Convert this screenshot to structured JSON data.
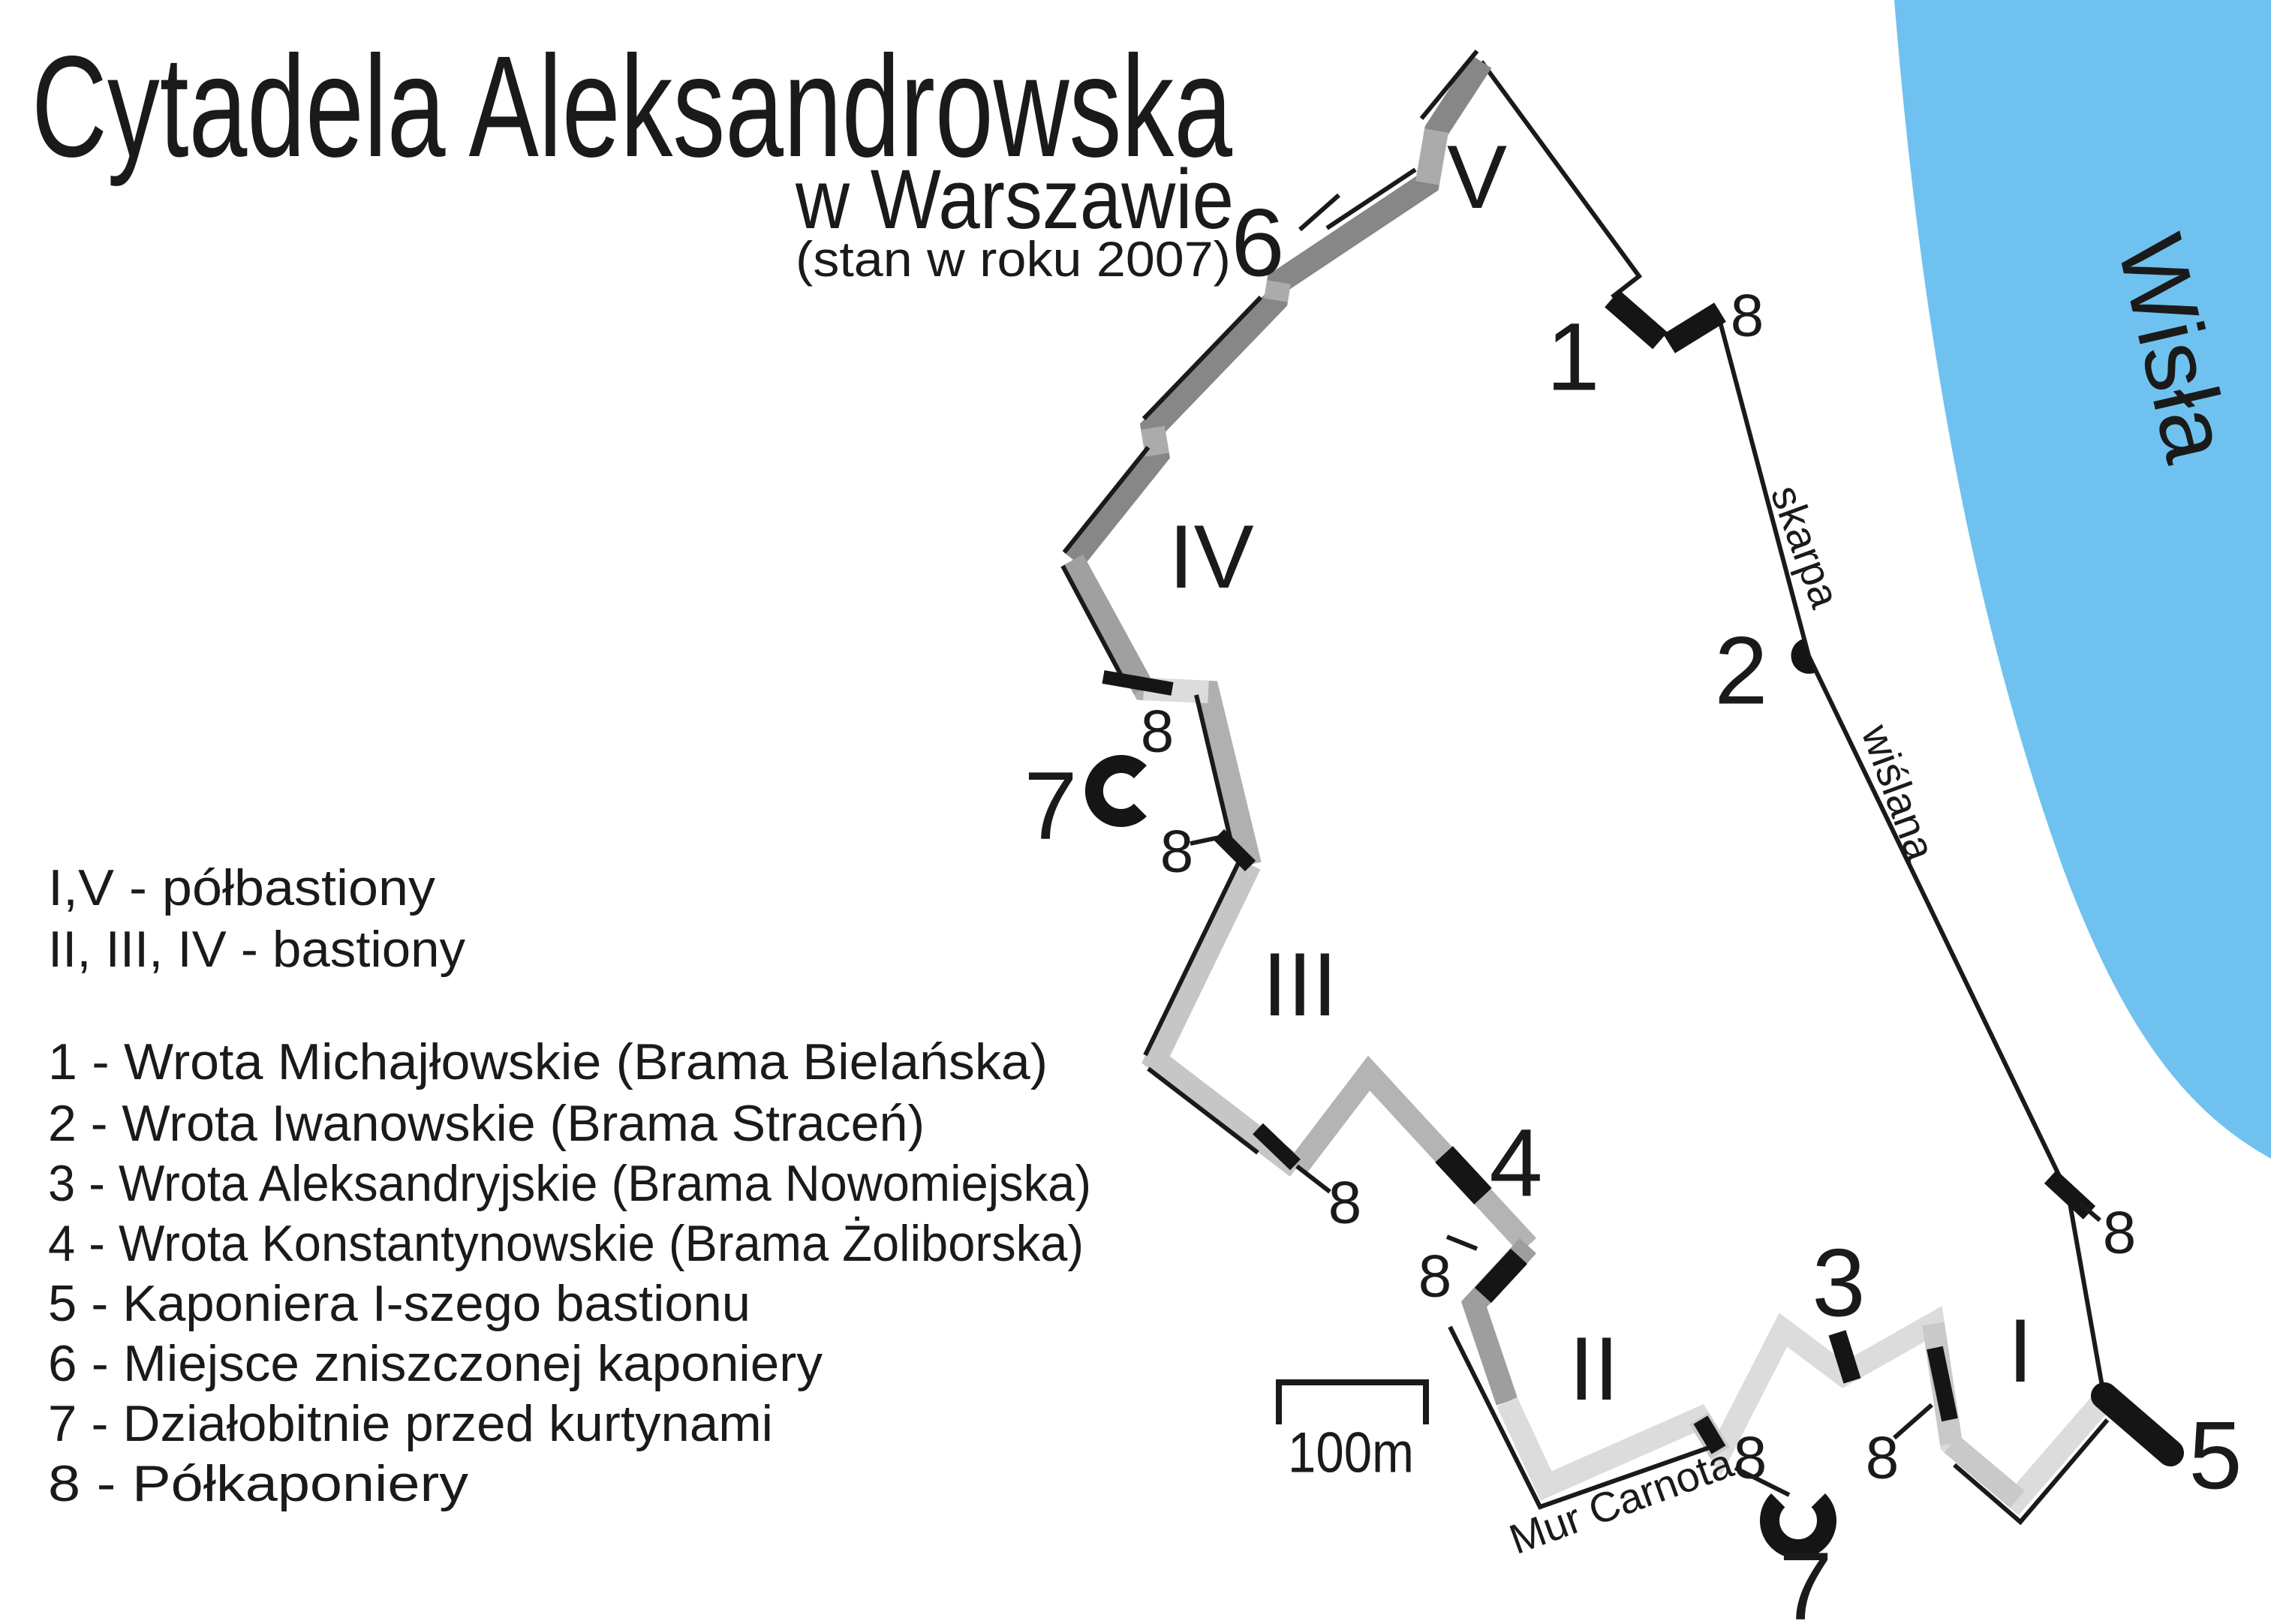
{
  "title": {
    "main": "Cytadela Aleksandrowska",
    "subtitle": "w Warszawie",
    "note": "(stan w roku 2007)"
  },
  "legend": {
    "classes": [
      "I,V - półbastiony",
      "II, III, IV - bastiony"
    ],
    "items": [
      "1 - Wrota Michajłowskie (Brama Bielańska)",
      "2 - Wrota Iwanowskie (Brama Straceń)",
      "3 - Wrota Aleksandryjskie (Brama Nowomiejska)",
      "4 - Wrota Konstantynowskie (Brama Żoliborska)",
      "5 - Kaponiera I-szego bastionu",
      "6 - Miejsce zniszczonej kaponiery",
      "7 - Działobitnie przed kurtynami",
      "8 - Półkaponiery"
    ]
  },
  "map": {
    "river_label": "Wisła",
    "scale_label": "100m",
    "escarpment_label_top": "skarpa",
    "escarpment_label_bottom": "wiślana",
    "carnot_wall_label": "Mur Carnota",
    "bastion_labels": {
      "b1": "I",
      "b2": "II",
      "b3": "III",
      "b4": "IV",
      "b5": "V"
    },
    "number_labels": {
      "n1": "1",
      "n2": "2",
      "n3": "3",
      "n4": "4",
      "n5": "5",
      "n6": "6",
      "n7": "7",
      "n8": "8"
    }
  },
  "colors": {
    "river": "#6fc2ef",
    "ink": "#1a1a1a",
    "wall_dark": "#878787",
    "wall_mid": "#9e9e9e",
    "wall_light": "#c6c6c6",
    "wall_lighter": "#dcdcdc"
  }
}
